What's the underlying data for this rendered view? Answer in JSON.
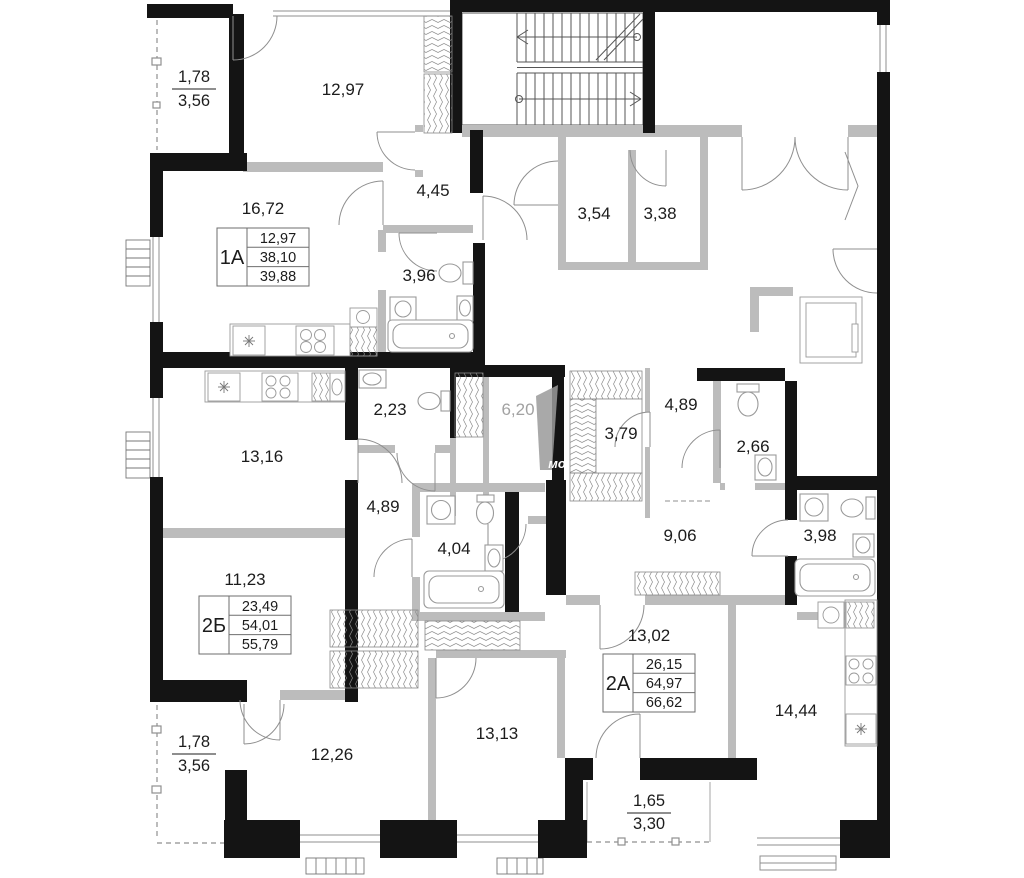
{
  "plan": {
    "watermark": "мо",
    "apartments": {
      "a1": {
        "id": "1А",
        "room_area": "16,72",
        "living_area": "12,97",
        "apartment_area": "38,10",
        "total_area": "39,88"
      },
      "b2": {
        "id": "2Б",
        "room_area": "11,23",
        "living_area": "23,49",
        "apartment_area": "54,01",
        "total_area": "55,79"
      },
      "a2": {
        "id": "2А",
        "room_area": "13,02",
        "living_area": "26,15",
        "apartment_area": "64,97",
        "total_area": "66,62"
      }
    },
    "balconies": {
      "top_left": {
        "width": "1,78",
        "area": "3,56"
      },
      "bottom_left": {
        "width": "1,78",
        "area": "3,56"
      },
      "bottom_center": {
        "width": "1,65",
        "area": "3,30"
      }
    },
    "rooms": {
      "room_12_97": "12,97",
      "hall_4_45": "4,45",
      "bath_3_96": "3,96",
      "storage_3_54": "3,54",
      "storage_3_38": "3,38",
      "wc_2_23": "2,23",
      "hall_6_20": "6,20",
      "wardrobe_3_79": "3,79",
      "corridor_4_89": "4,89",
      "wc_2_66": "2,66",
      "kitchen_13_16": "13,16",
      "hall_4_89": "4,89",
      "bath_4_04": "4,04",
      "corridor_9_06": "9,06",
      "bath_3_98": "3,98",
      "room_12_26": "12,26",
      "room_13_13": "13,13",
      "room_14_44": "14,44"
    },
    "colors": {
      "wall": "#141414",
      "partition": "#bcbcbc",
      "fixture": "#9a9a9a",
      "text": "#1c1c1c",
      "muted_text": "#a2a2a2"
    }
  }
}
